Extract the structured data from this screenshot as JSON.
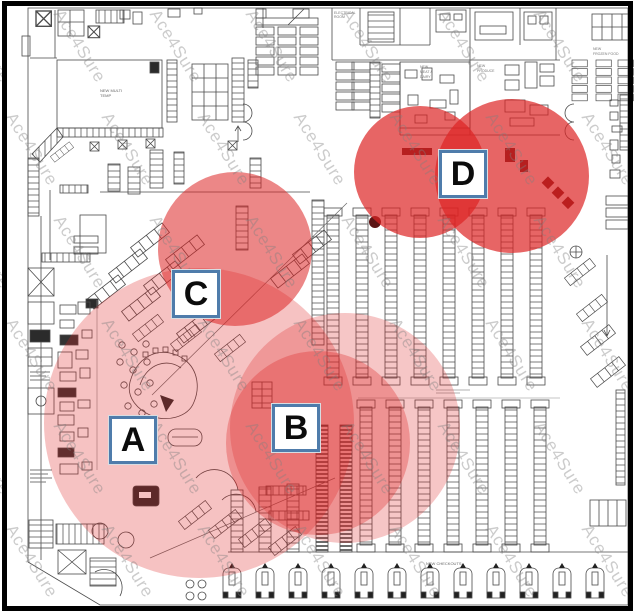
{
  "watermark": {
    "text": "Ace4Sure"
  },
  "colors": {
    "coverage_red": "#dd2424",
    "label_border": "#4f7cab",
    "label_text": "#0c0c0c",
    "plan_line": "#4a4a4a"
  },
  "zones": [
    {
      "label": "A",
      "box": {
        "cx": 133,
        "cy": 440
      },
      "circles": [
        {
          "cx": 199,
          "cy": 423,
          "r": 155,
          "opacity": 0.28
        }
      ]
    },
    {
      "label": "B",
      "box": {
        "cx": 296,
        "cy": 428
      },
      "circles": [
        {
          "cx": 345,
          "cy": 428,
          "r": 115,
          "opacity": 0.26
        },
        {
          "cx": 318,
          "cy": 443,
          "r": 92,
          "opacity": 0.32
        }
      ]
    },
    {
      "label": "C",
      "box": {
        "cx": 196,
        "cy": 294
      },
      "circles": [
        {
          "cx": 235,
          "cy": 249,
          "r": 77,
          "opacity": 0.55
        }
      ]
    },
    {
      "label": "D",
      "box": {
        "cx": 463,
        "cy": 174
      },
      "circles": [
        {
          "cx": 420,
          "cy": 172,
          "r": 66,
          "opacity": 0.7
        },
        {
          "cx": 512,
          "cy": 176,
          "r": 77,
          "opacity": 0.7
        }
      ]
    }
  ],
  "plan": {
    "labels": {
      "multi_temp": [
        "NEW MULTI",
        "TEMP"
      ],
      "electrical": [
        "ELECTRICAL",
        "ROOM"
      ],
      "meat_dairy": [
        "NEW",
        "MEAT &",
        "DAIRY"
      ],
      "produce": [
        "NEW",
        "PRODUCE"
      ],
      "frozen": [
        "NEW",
        "FROZEN FOOD"
      ],
      "checkouts": "NEW CHECKOUTS"
    }
  }
}
